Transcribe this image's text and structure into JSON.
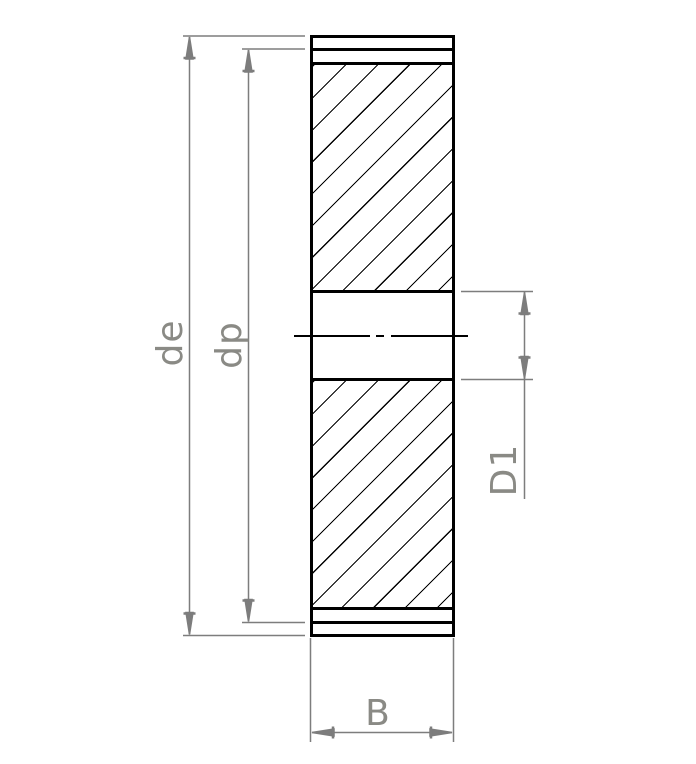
{
  "drawing": {
    "kind": "gear cross-section technical drawing"
  },
  "labels": {
    "outer_diameter": "de",
    "pitch_diameter": "dp",
    "bore_diameter": "D1",
    "face_width": "B"
  },
  "colors": {
    "outline": "#000000",
    "dimension_line": "#7d7d7d",
    "dimension_text": "#8a8a85",
    "background": "#ffffff"
  }
}
